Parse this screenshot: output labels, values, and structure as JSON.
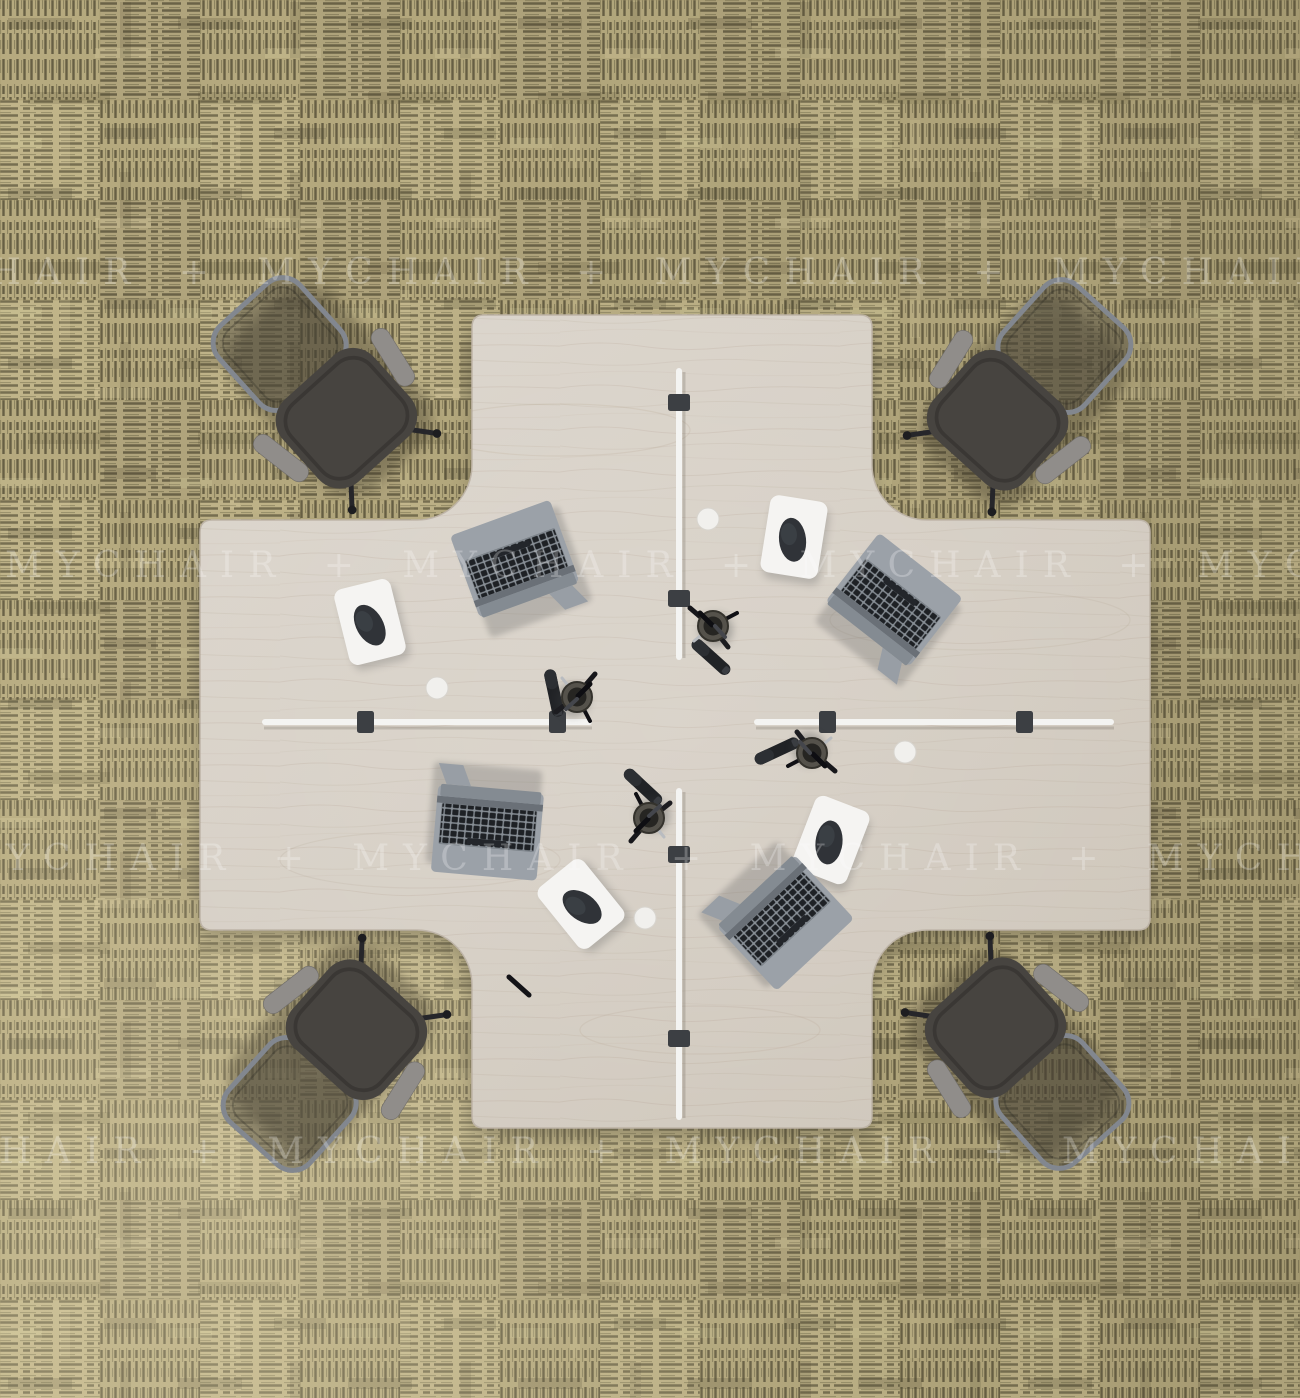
{
  "scene": {
    "subject": "Top view render of a 4-seat cross-shaped office workstation cluster on carpet tiles",
    "watermark": {
      "brand": "MYCHAIR",
      "separator": "+",
      "row_text": "MYCHAIR + MYCHAIR + MYCHAIR + MYCHAIR"
    },
    "objects": {
      "desk": "cross-shaped 4-person desk, light ash wood",
      "office_chairs": 4,
      "laptops": 4,
      "mouse_pads": 4,
      "mice": 4,
      "pen_cups": 4,
      "markers": 5,
      "privacy_screens": 4,
      "screen_clamps": 8,
      "cable_grommets": 4
    },
    "colors": {
      "carpet_base": "#b6aa7f",
      "carpet_stripe_dark": "#675f44",
      "carpet_stripe_light": "#948b66",
      "desk_wood": "#d8d1c7",
      "desk_edge": "#bdb3a6",
      "chair_fabric": "#474440",
      "chair_frame": "#82878f",
      "armrest_grey": "#908d8a",
      "laptop_body": "#9ba1a8",
      "laptop_keys": "#1e2125",
      "mousepad_white": "#f5f4f2",
      "mouse_dark": "#303338",
      "divider_white": "#f4f4f2",
      "clamp_grey": "#3c3f43",
      "watermark_white": "#ffffff"
    }
  }
}
